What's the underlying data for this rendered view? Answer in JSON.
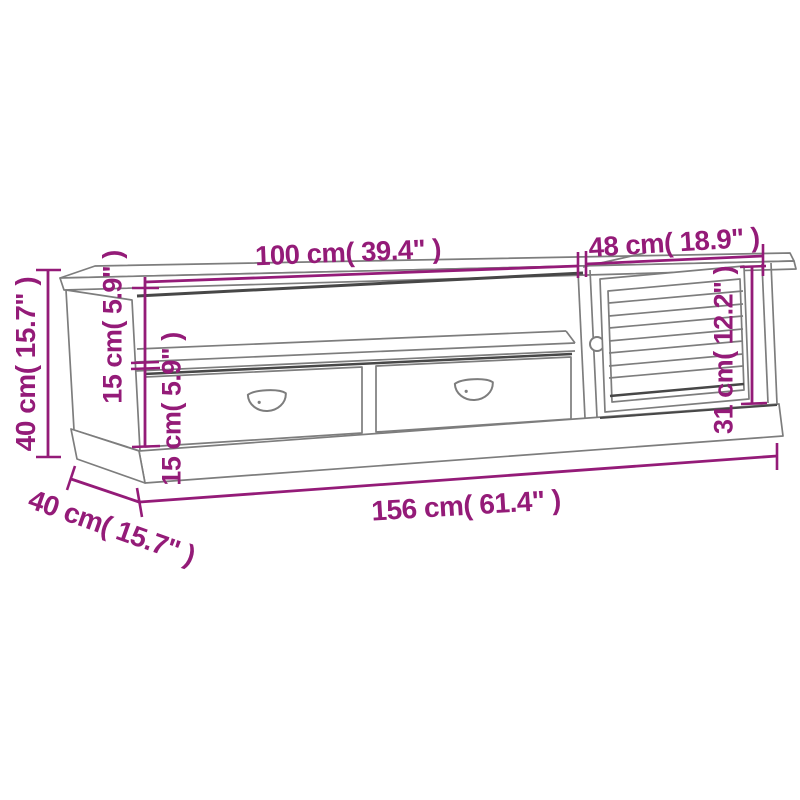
{
  "diagram": {
    "kind": "furniture-dimension-diagram",
    "colors": {
      "dimension_annotation": "#941b78",
      "outline_gray": "#7d7d7d",
      "shadow_dark": "#474747",
      "background": "#ffffff"
    },
    "dimensions": {
      "left_section_width": {
        "label": "100 cm( 39.4\" )",
        "cm": 100,
        "inches": 39.4
      },
      "right_section_width": {
        "label": "48 cm( 18.9\" )",
        "cm": 48,
        "inches": 18.9
      },
      "overall_height": {
        "label": "40 cm( 15.7\" )",
        "cm": 40,
        "inches": 15.7
      },
      "upper_compartment_height": {
        "label": "15 cm( 5.9\" )",
        "cm": 15,
        "inches": 5.9
      },
      "drawer_section_height": {
        "label": "15 cm( 5.9\" )",
        "cm": 15,
        "inches": 5.9
      },
      "door_section_height": {
        "label": "31 cm( 12.2\" )",
        "cm": 31,
        "inches": 12.2
      },
      "overall_width": {
        "label": "156 cm( 61.4\" )",
        "cm": 156,
        "inches": 61.4
      },
      "overall_depth": {
        "label": "40 cm( 15.7\" )",
        "cm": 40,
        "inches": 15.7
      }
    }
  }
}
